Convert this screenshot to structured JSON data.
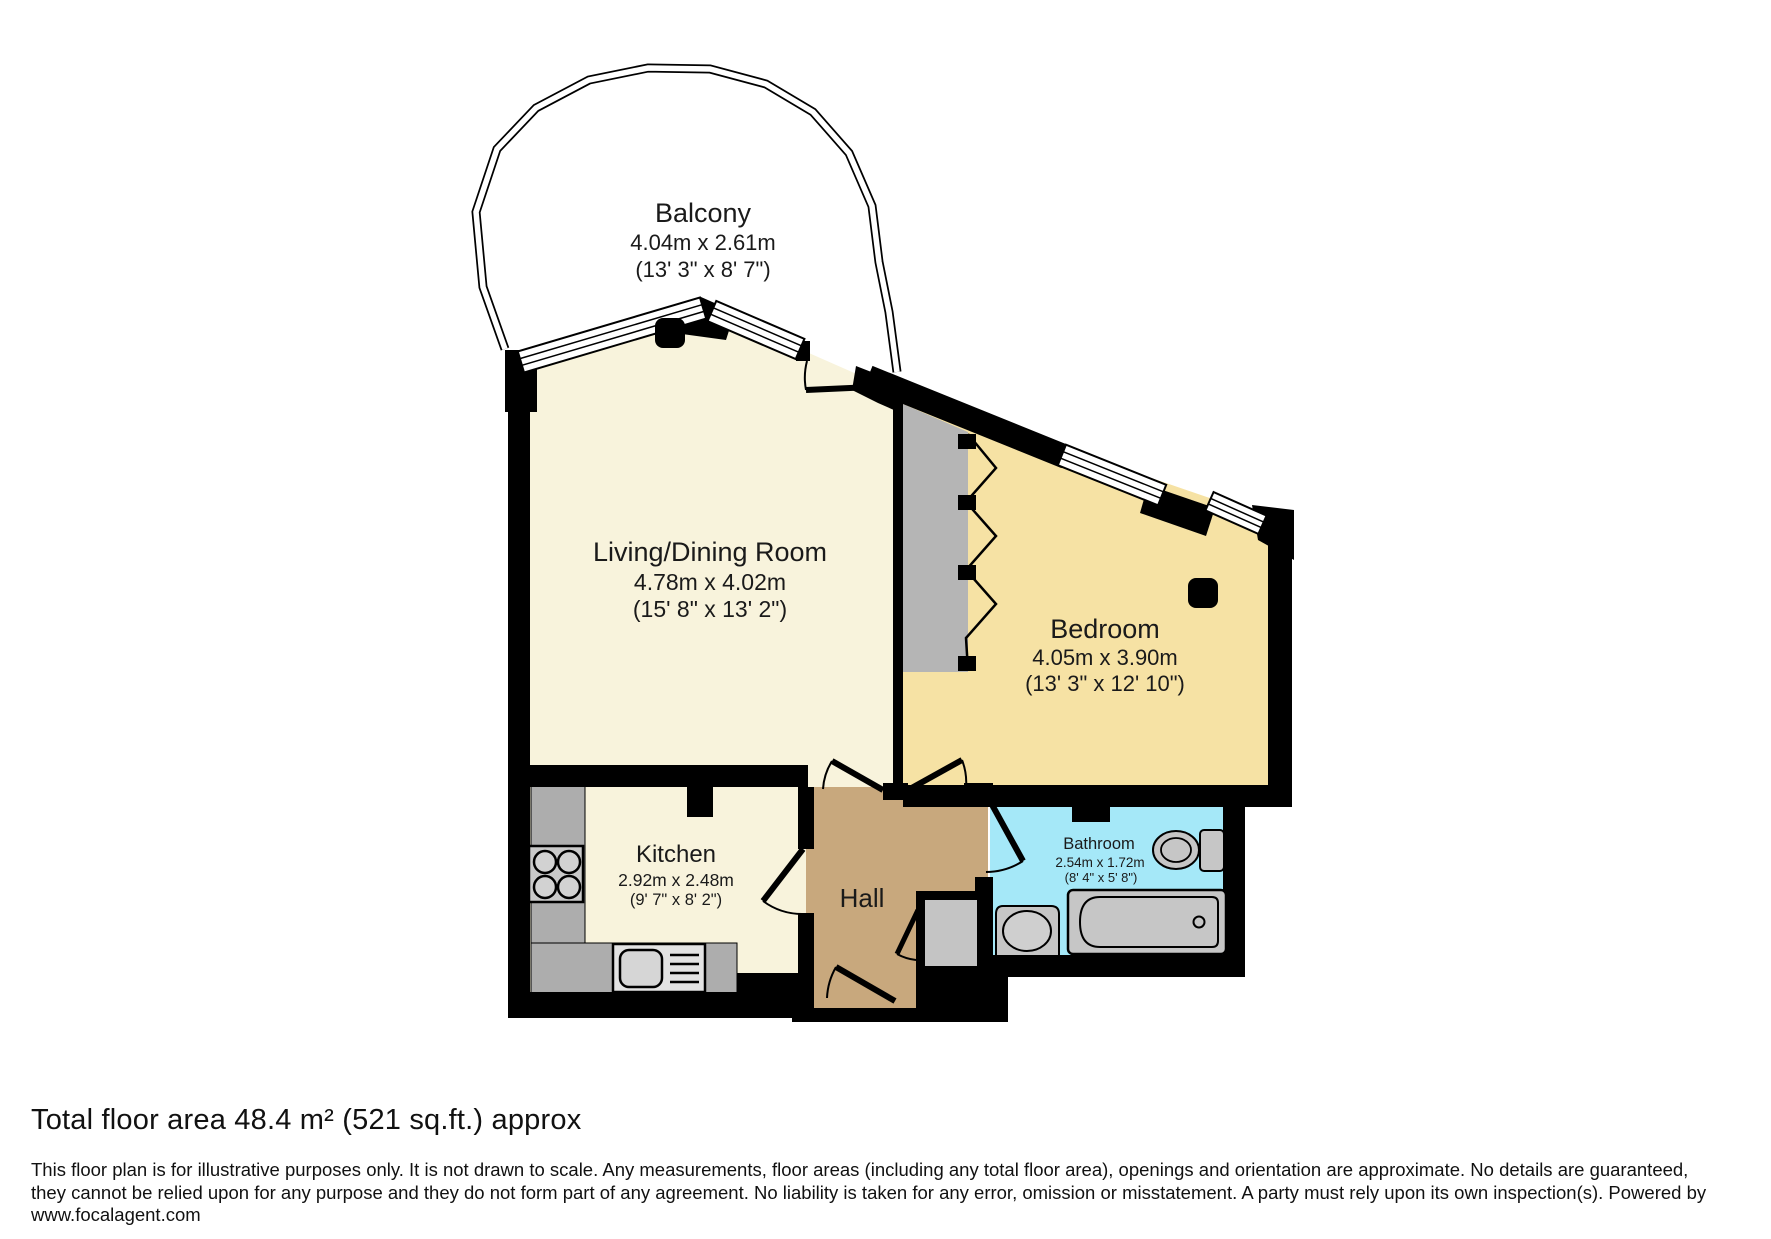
{
  "plan": {
    "balcony": {
      "name": "Balcony",
      "metric": "4.04m x 2.61m",
      "imperial": "(13' 3\" x 8' 7\")"
    },
    "living": {
      "name": "Living/Dining Room",
      "metric": "4.78m x 4.02m",
      "imperial": "(15' 8\" x 13' 2\")"
    },
    "bedroom": {
      "name": "Bedroom",
      "metric": "4.05m x 3.90m",
      "imperial": "(13' 3\" x 12' 10\")"
    },
    "kitchen": {
      "name": "Kitchen",
      "metric": "2.92m x 2.48m",
      "imperial": "(9' 7\" x 8' 2\")"
    },
    "hall": {
      "name": "Hall"
    },
    "bathroom": {
      "name": "Bathroom",
      "metric": "2.54m x 1.72m",
      "imperial": "(8' 4\" x 5' 8\")"
    }
  },
  "fixtures": {
    "hob": "hob-icon",
    "kitchen_sink": "kitchen-sink-icon",
    "toilet": "toilet-icon",
    "bathtub": "bathtub-icon",
    "basin": "basin-icon",
    "wardrobe": "wardrobe-bifold-doors",
    "column": "structural-column"
  },
  "colors": {
    "wall": "#000000",
    "living_kitchen_floor": "#F8F3DC",
    "bedroom_floor": "#F6E2A4",
    "hall_floor": "#C8A87D",
    "bathroom_floor": "#A5E8F8",
    "counter_gray": "#ADADAD",
    "wardrobe_gray": "#B5B5B5",
    "cupboard_gray": "#C4C4C4",
    "fixture_gray": "#C6C6C6"
  },
  "footer": {
    "total_area": "Total floor area 48.4 m² (521 sq.ft.) approx",
    "disclaimer_line1": "This floor plan is for illustrative purposes only. It is not drawn to scale. Any measurements, floor areas (including any total floor area), openings and orientation are approximate. No details are guaranteed,",
    "disclaimer_line2": "they cannot be relied upon for any purpose and they do not form part of any agreement. No liability is taken for any error, omission or misstatement. A party must rely upon its own inspection(s). Powered by",
    "disclaimer_line3": "www.focalagent.com"
  }
}
